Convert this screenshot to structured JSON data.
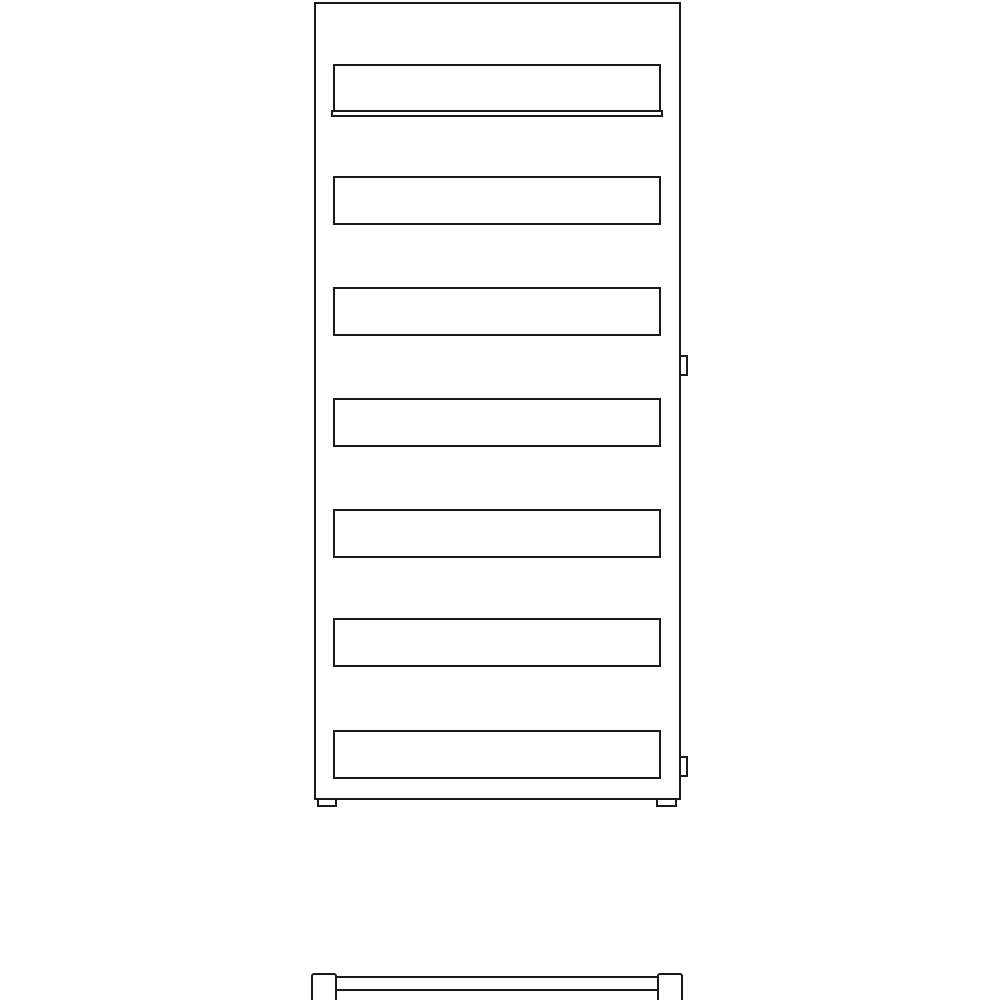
{
  "drawing": {
    "kind": "technical-line-drawing",
    "subject": "flat-panel towel radiator, front elevation with bottom plan view",
    "background_color": "#ffffff",
    "line_color": "#1a1a1a",
    "stroke_width_px": 2,
    "front_view": {
      "outline": {
        "name": "radiator-body-outline",
        "x": 314,
        "y": 2,
        "w": 367,
        "h": 798
      },
      "panel_count": 7,
      "panels": [
        {
          "name": "panel-1",
          "x": 333,
          "y": 64,
          "w": 328,
          "h": 48
        },
        {
          "name": "panel-2",
          "x": 333,
          "y": 176,
          "w": 328,
          "h": 49
        },
        {
          "name": "panel-3",
          "x": 333,
          "y": 287,
          "w": 328,
          "h": 49
        },
        {
          "name": "panel-4",
          "x": 333,
          "y": 398,
          "w": 328,
          "h": 49
        },
        {
          "name": "panel-5",
          "x": 333,
          "y": 509,
          "w": 328,
          "h": 49
        },
        {
          "name": "panel-6",
          "x": 333,
          "y": 618,
          "w": 328,
          "h": 49
        },
        {
          "name": "panel-7",
          "x": 333,
          "y": 730,
          "w": 328,
          "h": 49
        }
      ],
      "panel_1_bottom_edge": {
        "name": "panel-1-bottom-edge",
        "x": 331,
        "y": 110,
        "w": 332,
        "h": 7
      },
      "wall_brackets": [
        {
          "name": "bracket-upper-right",
          "x": 679,
          "y": 355,
          "w": 9,
          "h": 21
        },
        {
          "name": "bracket-lower-right",
          "x": 679,
          "y": 756,
          "w": 9,
          "h": 21
        }
      ],
      "feet": [
        {
          "name": "foot-left",
          "x": 317,
          "y": 798,
          "w": 20,
          "h": 9
        },
        {
          "name": "foot-right",
          "x": 656,
          "y": 798,
          "w": 21,
          "h": 9
        }
      ]
    },
    "bottom_view": {
      "body": {
        "name": "bottom-view-body",
        "x": 334,
        "y": 976,
        "w": 326,
        "h": 28
      },
      "mid_line": {
        "name": "bottom-view-mid-line",
        "x": 336,
        "y": 989,
        "w": 322,
        "h": 2
      },
      "end_caps": [
        {
          "name": "end-cap-left",
          "x": 311,
          "y": 973,
          "w": 26,
          "h": 31
        },
        {
          "name": "end-cap-right",
          "x": 657,
          "y": 973,
          "w": 26,
          "h": 31
        }
      ]
    }
  }
}
